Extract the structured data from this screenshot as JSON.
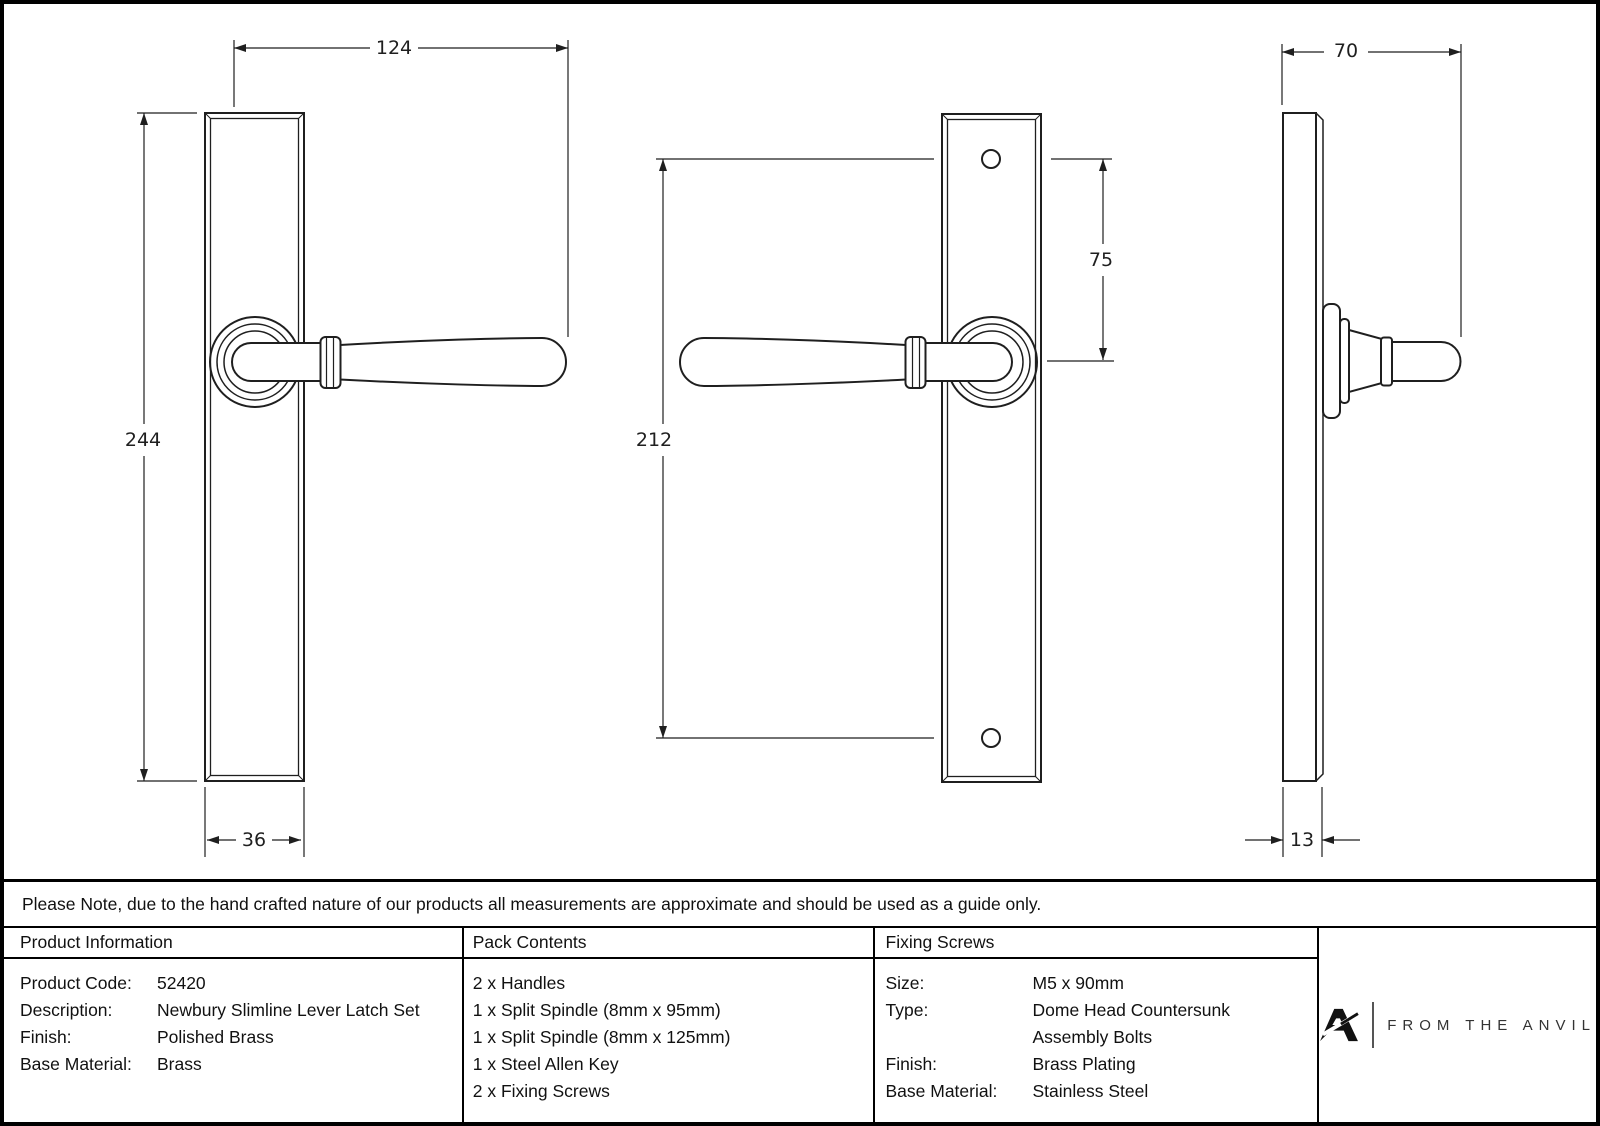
{
  "drawing": {
    "dimensions": {
      "front_lever_length": "124",
      "front_plate_height": "244",
      "front_plate_width": "36",
      "screw_centres_height": "212",
      "screw_to_handle_offset": "75",
      "side_projection": "70",
      "side_plate_thickness": "13"
    }
  },
  "note": "Please Note, due to the hand crafted nature of our products all measurements are approximate and should be used as a guide only.",
  "table": {
    "product_information": {
      "header": "Product Information",
      "rows": [
        {
          "label": "Product Code:",
          "value": "52420"
        },
        {
          "label": "Description:",
          "value": "Newbury Slimline Lever Latch Set"
        },
        {
          "label": "Finish:",
          "value": "Polished Brass"
        },
        {
          "label": "Base Material:",
          "value": "Brass"
        }
      ]
    },
    "pack_contents": {
      "header": "Pack Contents",
      "items": [
        "2 x Handles",
        "1 x Split Spindle (8mm x 95mm)",
        "1 x Split Spindle (8mm x 125mm)",
        "1 x Steel Allen Key",
        "2 x Fixing Screws"
      ]
    },
    "fixing_screws": {
      "header": "Fixing Screws",
      "rows": [
        {
          "label": "Size:",
          "value": "M5 x 90mm"
        },
        {
          "label": "Type:",
          "value": "Dome Head Countersunk"
        },
        {
          "label": "",
          "value": "Assembly Bolts"
        },
        {
          "label": "Finish:",
          "value": "Brass Plating"
        },
        {
          "label": "Base Material:",
          "value": "Stainless Steel"
        }
      ]
    },
    "brand": {
      "logo_text": "FROM THE ANVIL"
    }
  },
  "colors": {
    "line": "#1f1f1f",
    "border": "#000000",
    "background": "#ffffff",
    "logo_text": "#333333"
  }
}
